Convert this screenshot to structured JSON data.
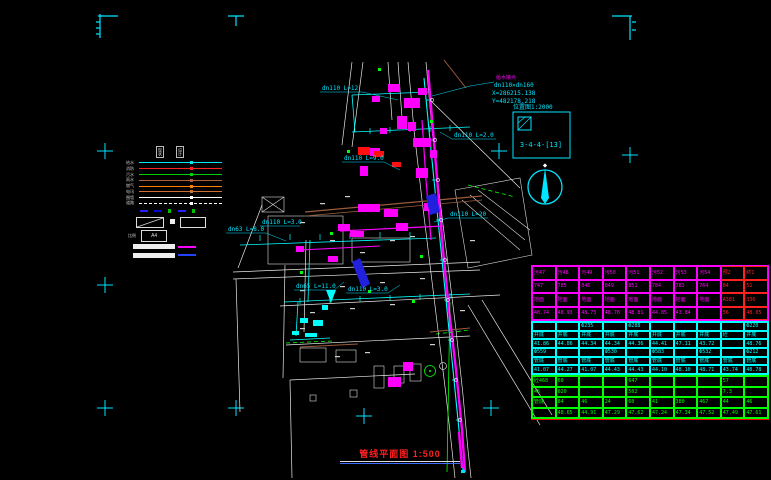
{
  "sheet": {
    "title": "管线平面图 1:500"
  },
  "detail_box": {
    "title": "位置图1:2000",
    "label": "3-4-4-[13]"
  },
  "connection_note": {
    "line1": "给水接点",
    "line2": "dn110×dn160",
    "line3": "X=286215.138",
    "line4": "Y=482178.218"
  },
  "annotations": {
    "pipe_labels": [
      {
        "text": "dn110 L=12"
      },
      {
        "text": "dn110 L=2.0"
      },
      {
        "text": "dn110 L=9.0"
      },
      {
        "text": "dn110 L=20"
      },
      {
        "text": "dn63 L=8.0"
      },
      {
        "text": "dn110 L=3.0"
      },
      {
        "text": "dn65 L=11.0"
      },
      {
        "text": "dn110 L=3.0"
      }
    ]
  },
  "legend": {
    "col_headers": [
      "现状",
      "设计"
    ],
    "lines": [
      {
        "label": "给水",
        "color": "#00e5ff",
        "dashed": false
      },
      {
        "label": "消防",
        "color": "#ff2020",
        "dashed": false
      },
      {
        "label": "污水",
        "color": "#00d000",
        "dashed": false
      },
      {
        "label": "雨水",
        "color": "#b06040",
        "dashed": false
      },
      {
        "label": "燃气",
        "color": "#ff8000",
        "dashed": false
      },
      {
        "label": "电讯",
        "color": "#d07030",
        "dashed": false
      },
      {
        "label": "围墙",
        "color": "#ffffff",
        "dashed": false
      },
      {
        "label": "道路",
        "color": "#ffffff",
        "dashed": true
      }
    ],
    "scale_label": "比例",
    "scale_value": "A4"
  },
  "colors": {
    "cyan": "#00ffff",
    "magenta": "#ff00ff",
    "red": "#ff2020",
    "green": "#00ff00",
    "table_red": "#ff2020"
  },
  "table": {
    "columns": 10,
    "sections": [
      {
        "color": "#ff00ff",
        "red_cols": [
          8,
          9
        ],
        "rows": [
          [
            "污47",
            "污48",
            "污49",
            "污50",
            "污51",
            "污52",
            "污53",
            "污54",
            "预2",
            "终1"
          ],
          [
            "747",
            "785",
            "846",
            "849",
            "851",
            "784",
            "783",
            "764",
            "84",
            "51"
          ],
          [
            "地面",
            "地面",
            "地面",
            "地面",
            "地面",
            "地面",
            "地面",
            "地面",
            "A381",
            "336"
          ],
          [
            "48.74",
            "48.93",
            "48.73",
            "48.76",
            "48.81",
            "44.85",
            "43.84",
            "",
            "56",
            "48.05"
          ]
        ]
      },
      {
        "color": "#00ffff",
        "red_cols": [],
        "rows": [
          [
            "",
            "",
            "Ф235",
            "",
            "Ф288",
            "",
            "",
            "",
            "",
            "Ф220"
          ],
          [
            "井底",
            "井底",
            "井底",
            "井底",
            "井底",
            "井底",
            "井底",
            "井底",
            "砼",
            "井底"
          ],
          [
            "41.86",
            "44.06",
            "44.34",
            "44.34",
            "44.36",
            "44.41",
            "47.11",
            "43.72",
            "",
            "48.76"
          ],
          [
            "Ф559",
            "",
            "",
            "Ф530",
            "",
            "Ф583",
            "",
            "Ф532",
            "",
            "Ф212"
          ],
          [
            "管底",
            "管底",
            "管底",
            "管底",
            "管底",
            "管底",
            "管底",
            "管底",
            "管底",
            "管底"
          ],
          [
            "41.07",
            "44.27",
            "41.07",
            "44.43",
            "44.43",
            "44.10",
            "48.10",
            "48.71",
            "43.74",
            "48.78"
          ]
        ]
      },
      {
        "color": "#00ff00",
        "red_cols": [],
        "rows": [
          [
            "砼468",
            "60",
            "",
            "",
            "647",
            "",
            "",
            "",
            "57",
            ""
          ],
          [
            "45",
            "020",
            "",
            "",
            "502",
            "",
            "",
            "",
            "7.3",
            ""
          ],
          [
            "管底",
            "84",
            "46",
            "24",
            "60",
            "41",
            "380",
            "467",
            "44",
            "46"
          ],
          [
            "",
            "48.65",
            "44.91",
            "47.29",
            "47.62",
            "47.24",
            "47.34",
            "47.52",
            "47.49",
            "47.61"
          ]
        ]
      }
    ]
  }
}
